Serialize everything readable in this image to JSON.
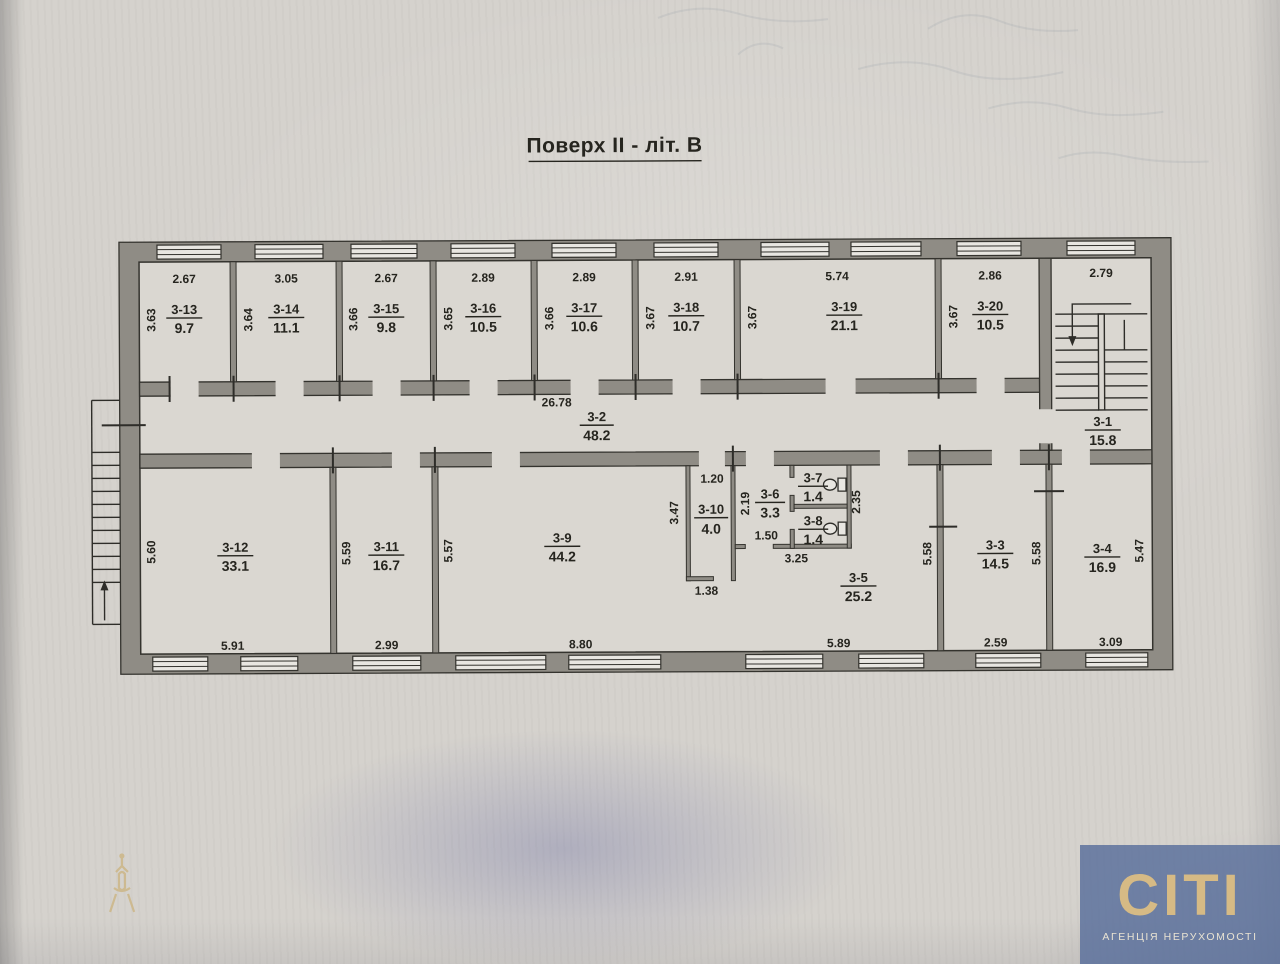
{
  "title": "Поверх II - літ. В",
  "logo": {
    "brand": "СІТІ",
    "subtitle": "АГЕНЦІЯ НЕРУХОМОСТІ"
  },
  "rooms": {
    "r3_13": {
      "id": "3-13",
      "area": "9.7",
      "w": "2.67",
      "h": "3.63"
    },
    "r3_14": {
      "id": "3-14",
      "area": "11.1",
      "w": "3.05",
      "h": "3.64"
    },
    "r3_15": {
      "id": "3-15",
      "area": "9.8",
      "w": "2.67",
      "h": "3.66"
    },
    "r3_16": {
      "id": "3-16",
      "area": "10.5",
      "w": "2.89",
      "h": "3.65"
    },
    "r3_17": {
      "id": "3-17",
      "area": "10.6",
      "w": "2.89",
      "h": "3.66"
    },
    "r3_18": {
      "id": "3-18",
      "area": "10.7",
      "w": "2.91",
      "h": "3.67"
    },
    "r3_19": {
      "id": "3-19",
      "area": "21.1",
      "w": "5.74",
      "h": "3.67"
    },
    "r3_20": {
      "id": "3-20",
      "area": "10.5",
      "w": "2.86",
      "h": "3.67"
    },
    "r3_1": {
      "id": "3-1",
      "area": "15.8",
      "w": "2.79"
    },
    "r3_2": {
      "id": "3-2",
      "area": "48.2",
      "len": "26.78"
    },
    "r3_12": {
      "id": "3-12",
      "area": "33.1",
      "h": "5.60",
      "wb": "5.91"
    },
    "r3_11": {
      "id": "3-11",
      "area": "16.7",
      "h": "5.59",
      "wb": "2.99"
    },
    "r3_9": {
      "id": "3-9",
      "area": "44.2",
      "h": "5.57",
      "wb": "8.80"
    },
    "r3_10": {
      "id": "3-10",
      "area": "4.0",
      "wt": "1.20",
      "h": "3.47",
      "wb": "1.38"
    },
    "r3_6": {
      "id": "3-6",
      "area": "3.3",
      "h": "2.19",
      "wb": "1.50"
    },
    "r3_7": {
      "id": "3-7",
      "area": "1.4"
    },
    "r3_8": {
      "id": "3-8",
      "area": "1.4"
    },
    "wc_block": {
      "h_right": "2.35",
      "wb": "3.25"
    },
    "r3_5": {
      "id": "3-5",
      "area": "25.2",
      "wb": "5.89",
      "h_right": "5.58"
    },
    "r3_3": {
      "id": "3-3",
      "area": "14.5",
      "wb": "2.59",
      "h_right": "5.58"
    },
    "r3_4": {
      "id": "3-4",
      "area": "16.9",
      "wb": "3.09",
      "h_right": "5.47"
    }
  }
}
